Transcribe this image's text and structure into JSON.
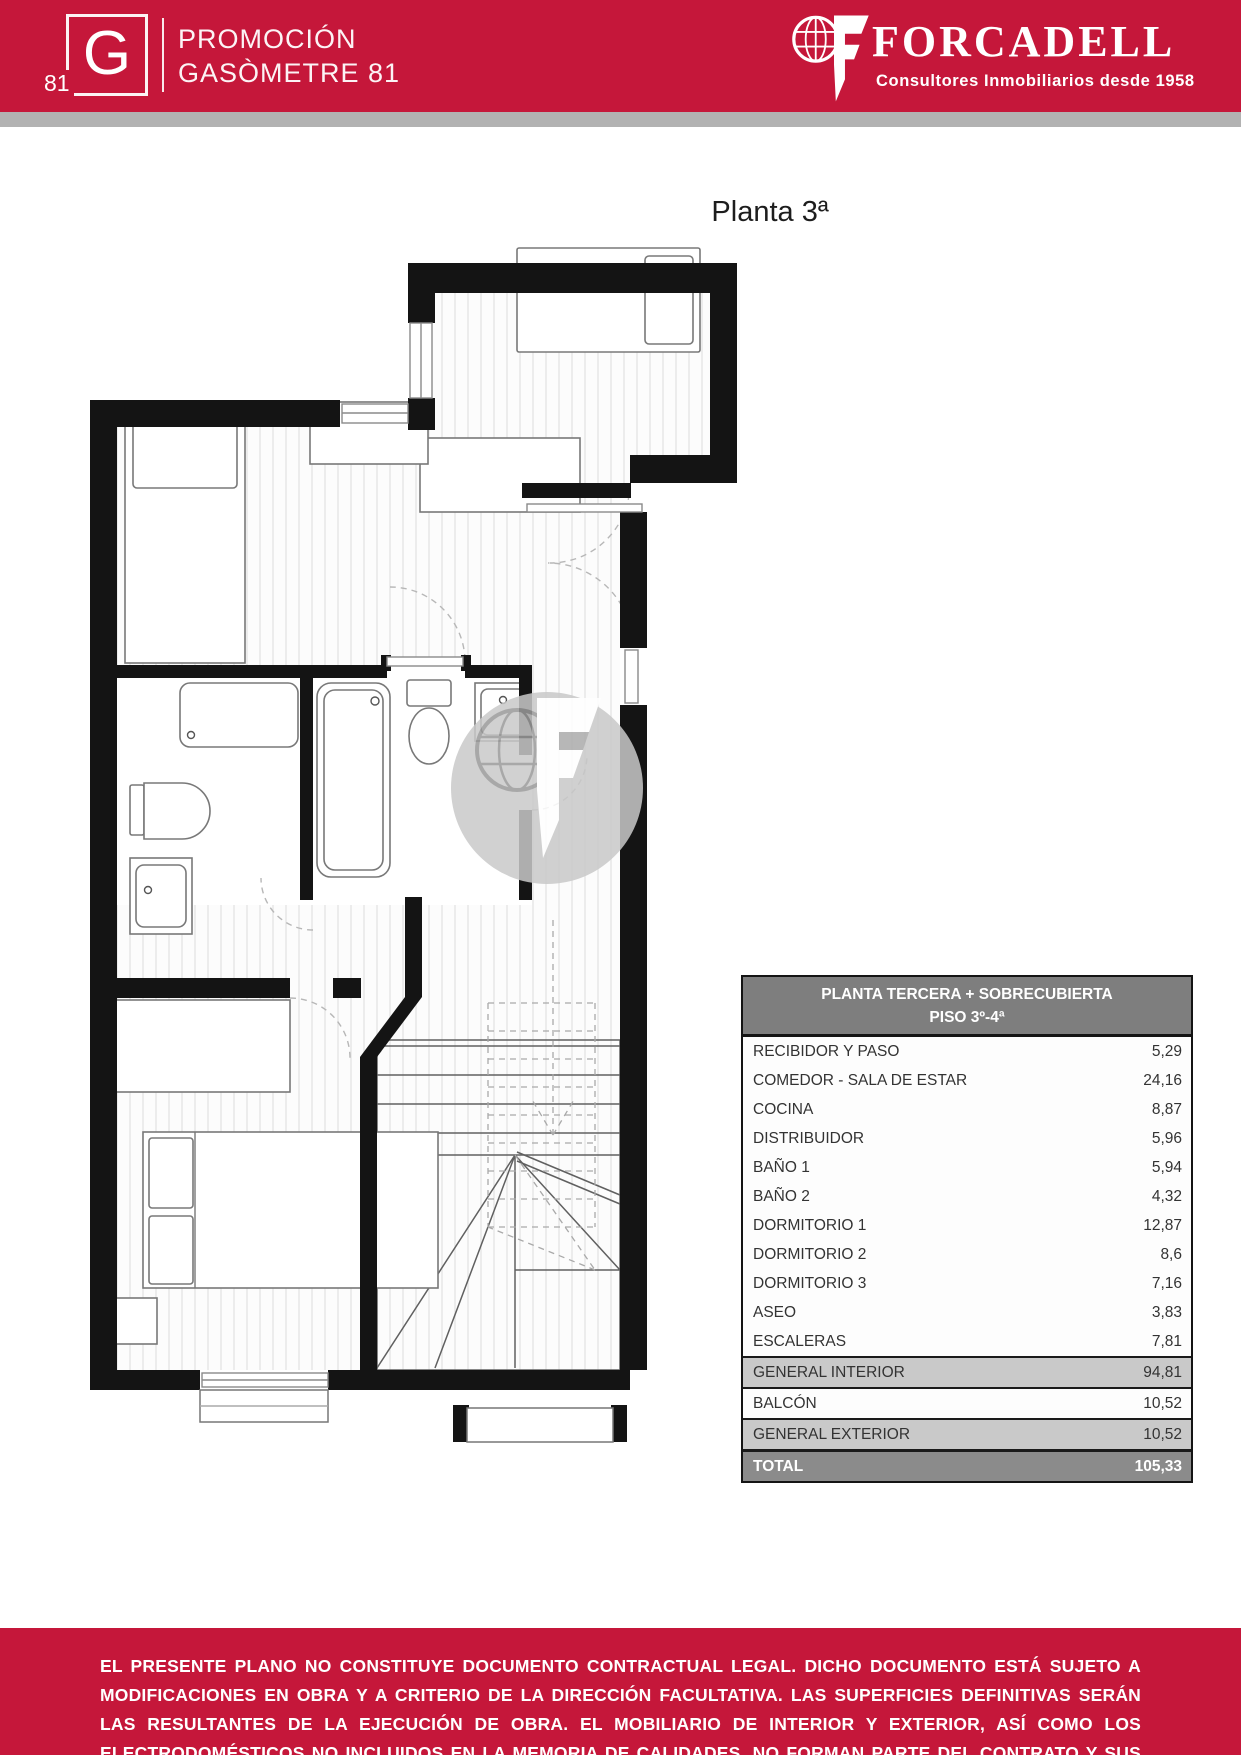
{
  "header": {
    "brand": {
      "logo_letter": "G",
      "logo_number": "81",
      "line1": "PROMOCIÓN",
      "line2": "GASÒMETRE 81"
    },
    "company": {
      "name": "FORCADELL",
      "tagline": "Consultores Inmobiliarios desde 1958"
    }
  },
  "plan": {
    "title": "Planta 3ª"
  },
  "table": {
    "title_line1": "PLANTA TERCERA + SOBRECUBIERTA",
    "title_line2": "PISO 3º-4ª",
    "rows": [
      {
        "label": "RECIBIDOR Y PASO",
        "value": "5,29",
        "kind": "normal"
      },
      {
        "label": "COMEDOR - SALA DE ESTAR",
        "value": "24,16",
        "kind": "normal"
      },
      {
        "label": "COCINA",
        "value": "8,87",
        "kind": "normal"
      },
      {
        "label": "DISTRIBUIDOR",
        "value": "5,96",
        "kind": "normal"
      },
      {
        "label": "BAÑO 1",
        "value": "5,94",
        "kind": "normal"
      },
      {
        "label": "BAÑO 2",
        "value": "4,32",
        "kind": "normal"
      },
      {
        "label": "DORMITORIO 1",
        "value": "12,87",
        "kind": "normal"
      },
      {
        "label": "DORMITORIO 2",
        "value": "8,6",
        "kind": "normal"
      },
      {
        "label": "DORMITORIO 3",
        "value": "7,16",
        "kind": "normal"
      },
      {
        "label": "ASEO",
        "value": "3,83",
        "kind": "normal"
      },
      {
        "label": "ESCALERAS",
        "value": "7,81",
        "kind": "normal"
      },
      {
        "label": "GENERAL INTERIOR",
        "value": "94,81",
        "kind": "subtotal"
      },
      {
        "label": "BALCÓN",
        "value": "10,52",
        "kind": "normal"
      },
      {
        "label": "GENERAL EXTERIOR",
        "value": "10,52",
        "kind": "subtotal"
      },
      {
        "label": "TOTAL",
        "value": "105,33",
        "kind": "total"
      }
    ]
  },
  "footer": {
    "disclaimer": "EL PRESENTE PLANO NO CONSTITUYE DOCUMENTO CONTRACTUAL LEGAL. DICHO DOCUMENTO ESTÁ SUJETO A MODIFICACIONES EN OBRA Y A CRITERIO DE LA DIRECCIÓN FACULTATIVA. LAS SUPERFICIES DEFINITIVAS SERÁN LAS RESULTANTES DE LA EJECUCIÓN DE OBRA. EL MOBILIARIO DE INTERIOR Y EXTERIOR, ASÍ COMO LOS ELECTRODOMÉSTICOS NO INCLUIDOS EN LA MEMORIA DE CALIDADES, NO FORMAN PARTE DEL CONTRATO Y SUS DIMENSIONES Y UBICACIONES SON ORIENTATIVAS"
  },
  "colors": {
    "brand_red": "#c5173a",
    "divider_gray": "#b2b2b2",
    "table_header_gray": "#7e7e7e",
    "table_subtotal_gray": "#c9c9c9",
    "table_total_gray": "#8b8b8b"
  }
}
